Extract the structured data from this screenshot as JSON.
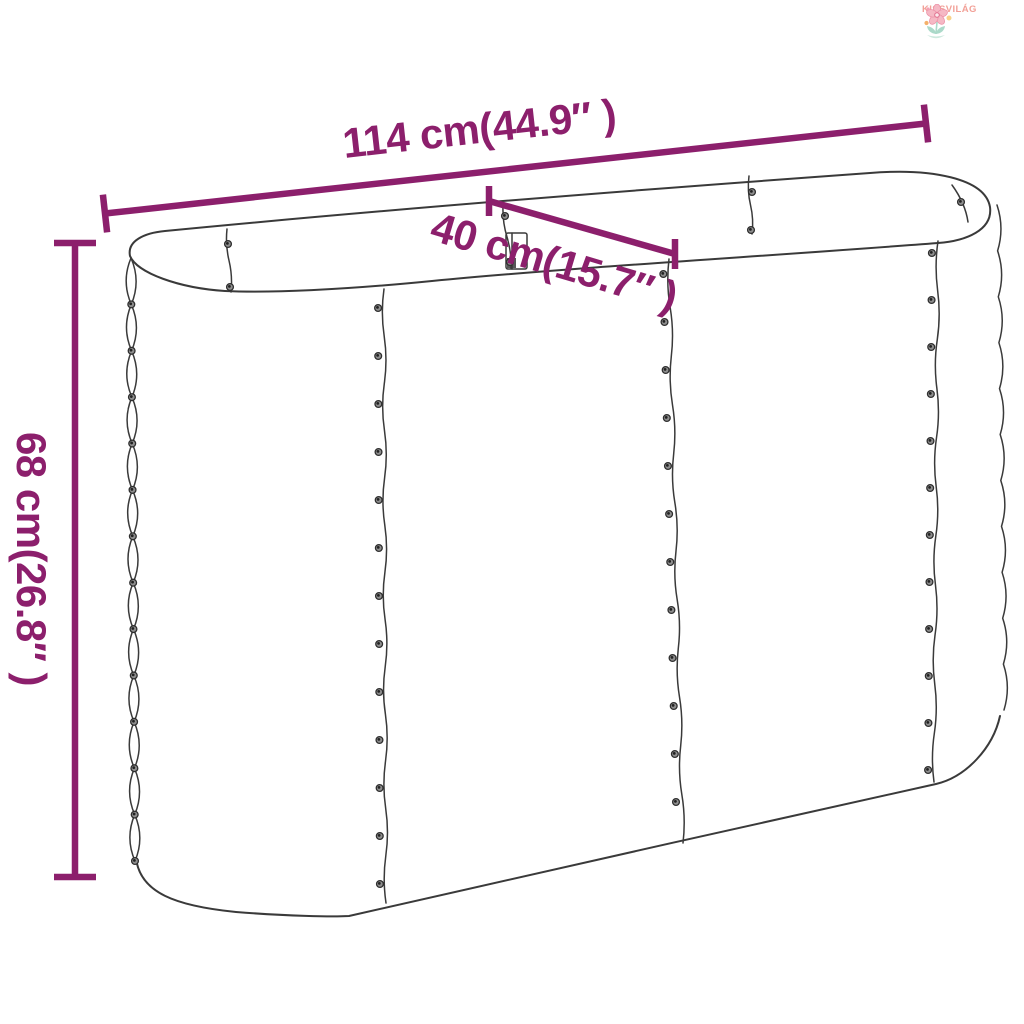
{
  "logo": {
    "brand": "KISSVILÁG"
  },
  "diagram": {
    "subject": "oval raised garden bed planter — dimension line drawing",
    "labels": {
      "width": "114 cm(44.9″ )",
      "depth": "40 cm(15.7″ )",
      "height": "68 cm(26.8″ )"
    },
    "colors": {
      "background": "#FFFFFF",
      "dimension_accent": "#8C1F6C",
      "line_art": "#3A3A3A",
      "logo_text": "#F2A097",
      "logo_petal": "#F5B8C4",
      "logo_petal_stroke": "#EC93A8",
      "logo_flower_center": "#E0708E",
      "logo_leaf": "#ABD9C9",
      "logo_leaf_light": "#CDE9DE",
      "logo_dot_orange": "#F4B06A",
      "logo_dot_yellow": "#F8D28A",
      "logo_dot_pink": "#F3A2B5"
    }
  }
}
